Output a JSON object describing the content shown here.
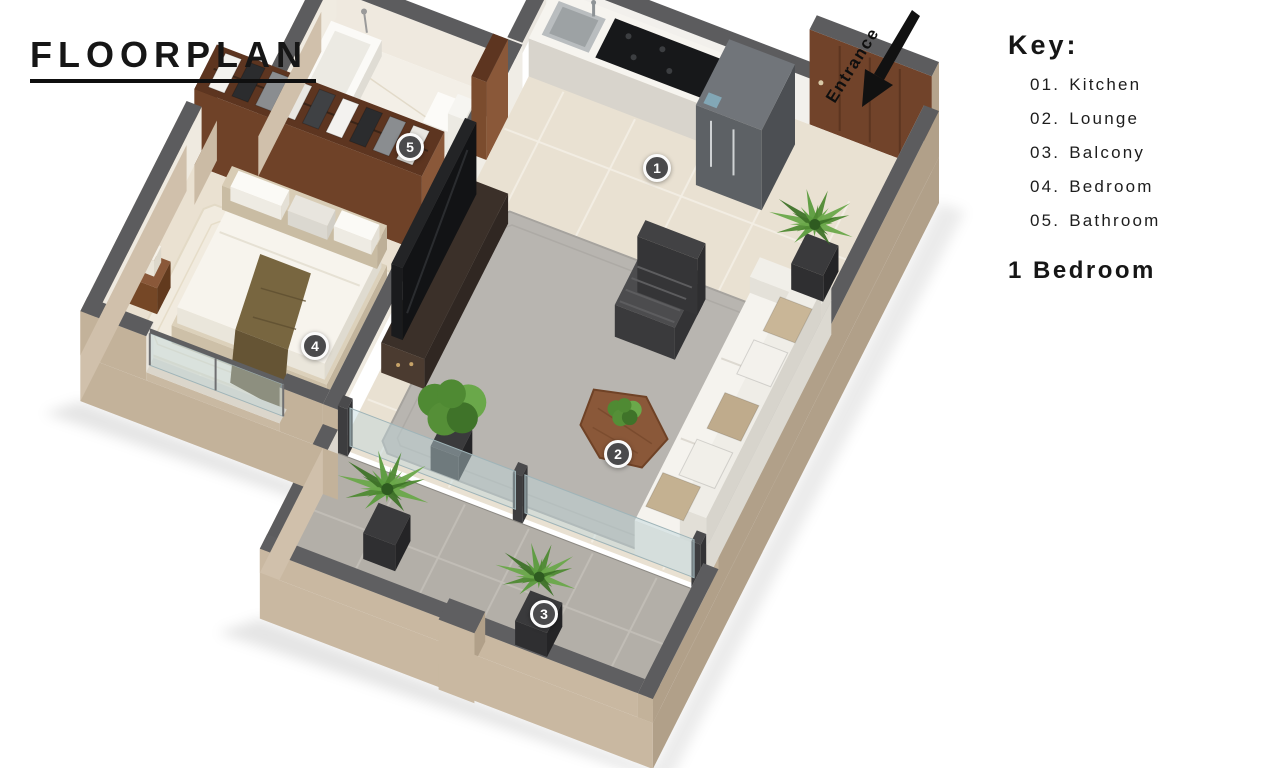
{
  "title": "FLOORPLAN",
  "entrance": {
    "label": "Entrance"
  },
  "key": {
    "heading": "Key:",
    "items": [
      {
        "number": "01.",
        "label": "Kitchen"
      },
      {
        "number": "02.",
        "label": "Lounge"
      },
      {
        "number": "03.",
        "label": "Balcony"
      },
      {
        "number": "04.",
        "label": "Bedroom"
      },
      {
        "number": "05.",
        "label": "Bathroom"
      }
    ],
    "summary": "1 Bedroom"
  },
  "markers": [
    {
      "number": "1"
    },
    {
      "number": "2"
    },
    {
      "number": "3"
    },
    {
      "number": "4"
    },
    {
      "number": "5"
    }
  ],
  "colors": {
    "wall_top": "#5c5c5e",
    "wall_exterior_tan": "#c9b8a1",
    "wall_exterior_light": "#d0c0ab",
    "wall_exterior_dark": "#b1a089",
    "wood_brown": "#71432a",
    "wood_dark": "#5d3520",
    "wood_light": "#8a5839",
    "floor_tile_beige": "#e9e1d2",
    "bath_floor": "#f3efe7",
    "bed_floor": "#eae1d1",
    "rug_gray": "#b8b5b0",
    "balcony_floor": "#b3afa8",
    "plant_green": "#4f8a33",
    "marker_fill": "#4a4a4c",
    "text_black": "#161616"
  }
}
